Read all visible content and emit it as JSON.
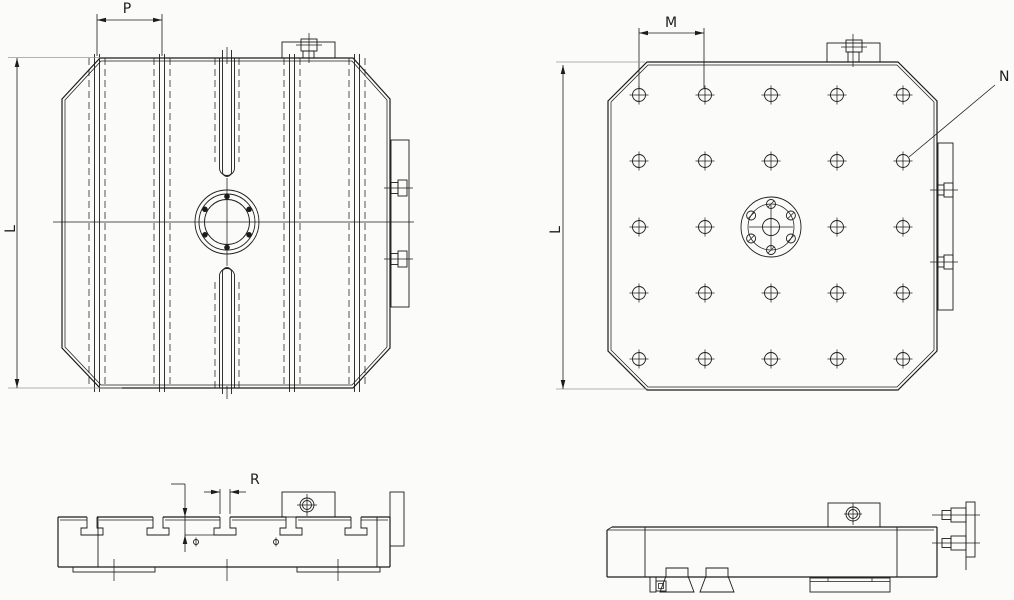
{
  "canvas": {
    "background": "#fbfbf9",
    "line_color": "#1c1c1c",
    "aux_line_color": "#9a9a9a"
  },
  "dimensions": {
    "slot_pitch": "P",
    "plate_height_left": "L",
    "hole_pitch": "M",
    "plate_height_right": "L",
    "hole_callout": "N",
    "slot_width": "R"
  }
}
